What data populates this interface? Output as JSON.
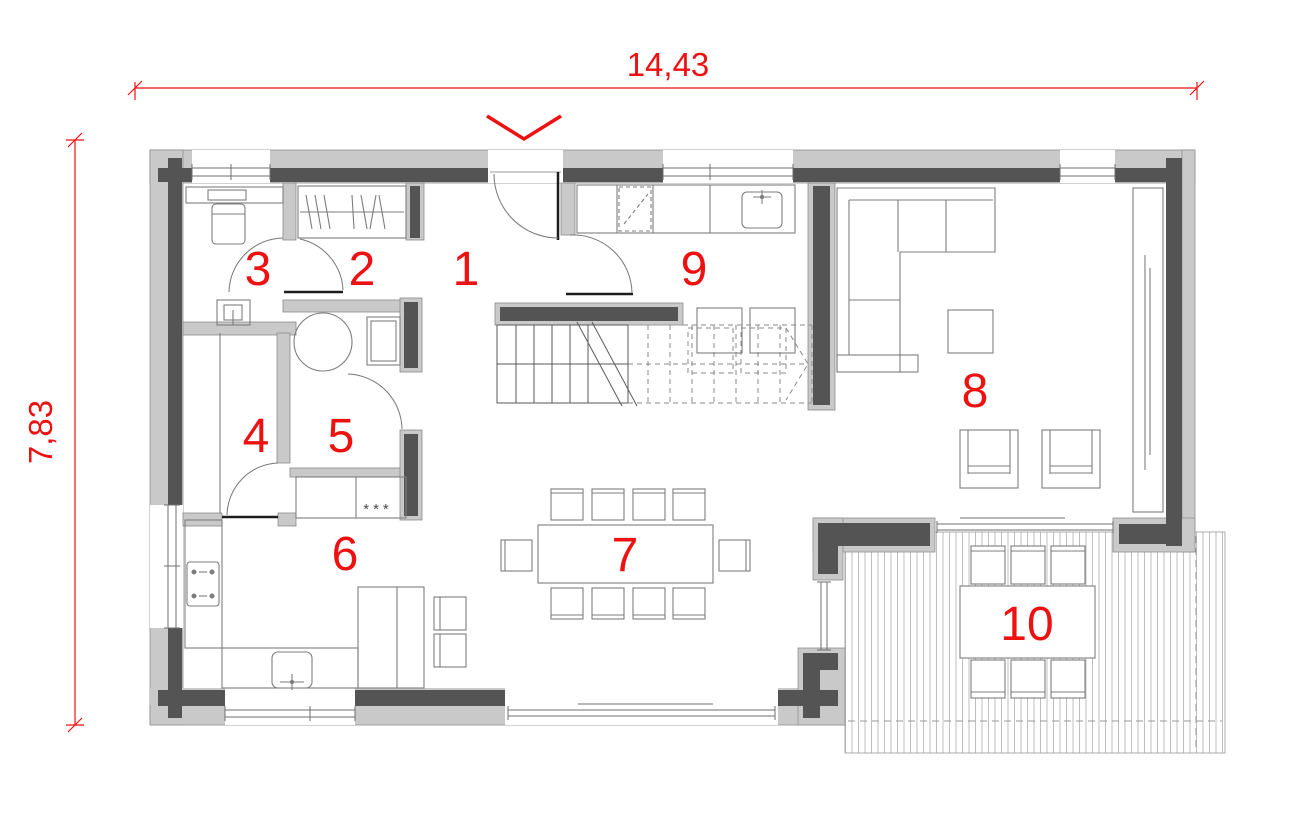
{
  "plan": {
    "dimension_top": "14,43",
    "dimension_left": "7,83",
    "room_labels": {
      "r1": "1",
      "r2": "2",
      "r3": "3",
      "r4": "4",
      "r5": "5",
      "r6": "6",
      "r7": "7",
      "r8": "8",
      "r9": "9",
      "r10": "10"
    },
    "freezer_symbol": "***",
    "colors": {
      "dimension_red": "#ee1111",
      "label_red": "#ee1111",
      "wall_core": "#545454",
      "wall_insulation": "#c9c9c9",
      "furniture_line": "#7d7d7d"
    }
  }
}
